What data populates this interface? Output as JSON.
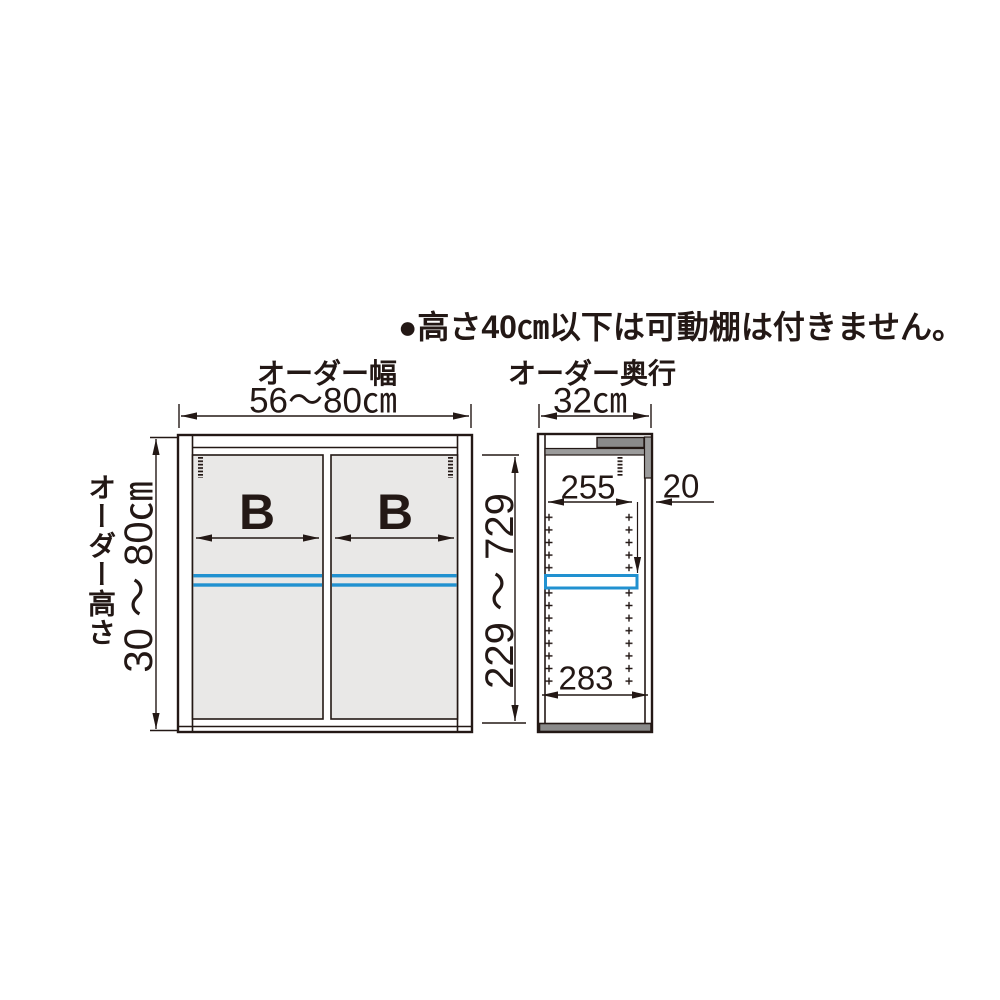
{
  "note": {
    "text": "●高さ40㎝以下は可動棚は付きません。"
  },
  "front_view": {
    "width_label": "オーダー幅",
    "width_value": "56～80㎝",
    "height_label": "オーダー高さ",
    "height_value": "30 ～ 80㎝",
    "inner_height_range": "229 ～ 729",
    "left_door_label": "B",
    "right_door_label": "B"
  },
  "side_view": {
    "depth_label": "オーダー奥行",
    "depth_value": "32㎝",
    "top_inner_depth": "255",
    "back_panel_thickness": "20",
    "bottom_inner_depth": "283"
  },
  "colors": {
    "line": "#231815",
    "door_fill": "#e9e8e7",
    "panel_gray": "#9b9b9b",
    "panel_dark_gray": "#8a8a8a",
    "shelf_blue": "#2191d0"
  }
}
